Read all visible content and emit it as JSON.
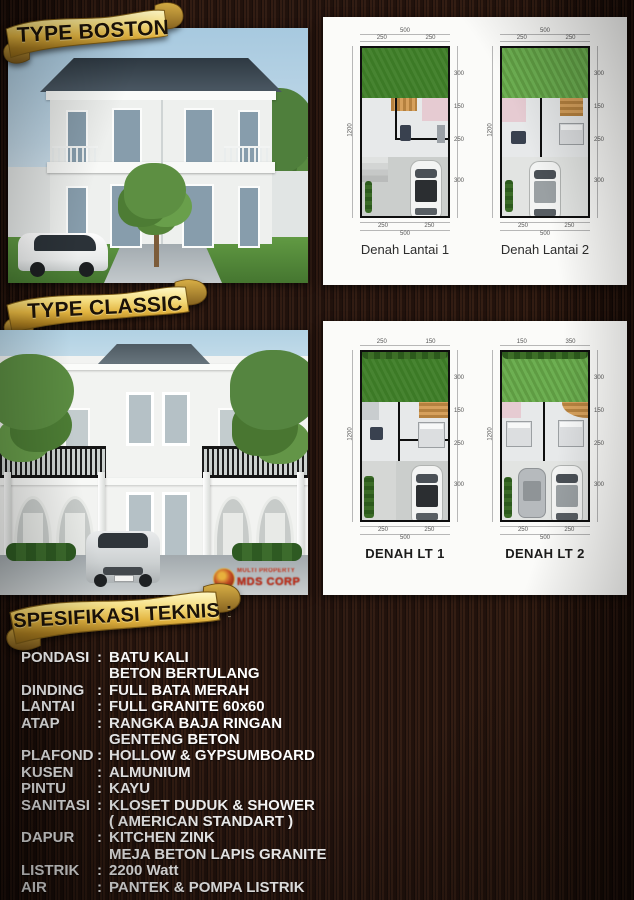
{
  "banners": {
    "boston": "TYPE BOSTON",
    "classic": "TYPE CLASSIC",
    "spec": "SPESIFIKASI TEKNIS :"
  },
  "plans": {
    "boston": [
      {
        "caption": "Denah Lantai 1",
        "dims": {
          "top_total": "500",
          "top": [
            "250",
            "250"
          ],
          "left_total": "1200",
          "right": [
            "300",
            "150",
            "250",
            "300"
          ],
          "bottom": [
            "250",
            "250"
          ],
          "bottom_total": "500"
        }
      },
      {
        "caption": "Denah Lantai 2",
        "dims": {
          "top_total": "500",
          "top": [
            "250",
            "250"
          ],
          "left_total": "1200",
          "right": [
            "300",
            "150",
            "250",
            "300"
          ],
          "bottom": [
            "250",
            "250"
          ],
          "bottom_total": "500"
        }
      }
    ],
    "classic": [
      {
        "caption": "DENAH LT 1",
        "dims": {
          "top_total": "500",
          "top": [
            "250",
            "150"
          ],
          "left_total": "1200",
          "right": [
            "300",
            "150",
            "250",
            "300"
          ],
          "bottom": [
            "250",
            "250"
          ],
          "bottom_total": "500"
        }
      },
      {
        "caption": "DENAH LT 2",
        "dims": {
          "top_total": "500",
          "top": [
            "150",
            "350"
          ],
          "left_total": "1200",
          "right": [
            "300",
            "150",
            "250",
            "300"
          ],
          "bottom": [
            "250",
            "250"
          ],
          "bottom_total": "500"
        }
      }
    ]
  },
  "spec": {
    "rows": [
      {
        "label": "PONDASI",
        "colon": ":",
        "value": "BATU KALI"
      },
      {
        "label": "",
        "colon": "",
        "value": "BETON BERTULANG"
      },
      {
        "label": "DINDING",
        "colon": ":",
        "value": "FULL BATA MERAH"
      },
      {
        "label": "LANTAI",
        "colon": ":",
        "value": "FULL GRANITE 60x60"
      },
      {
        "label": "ATAP",
        "colon": ":",
        "value": "RANGKA BAJA RINGAN"
      },
      {
        "label": "",
        "colon": "",
        "value": "GENTENG BETON"
      },
      {
        "label": "PLAFOND",
        "colon": ":",
        "value": "HOLLOW & GYPSUMBOARD"
      },
      {
        "label": "KUSEN",
        "colon": ":",
        "value": "ALMUNIUM"
      },
      {
        "label": "PINTU",
        "colon": ":",
        "value": "KAYU"
      },
      {
        "label": "SANITASI",
        "colon": ":",
        "value": "KLOSET DUDUK & SHOWER"
      },
      {
        "label": "",
        "colon": "",
        "value": "( AMERICAN STANDART )"
      },
      {
        "label": "DAPUR",
        "colon": ":",
        "value": "KITCHEN ZINK"
      },
      {
        "label": "",
        "colon": "",
        "value": "MEJA BETON LAPIS GRANITE"
      },
      {
        "label": "LISTRIK",
        "colon": ":",
        "value": "2200 Watt"
      },
      {
        "label": "AIR",
        "colon": ":",
        "value": "PANTEK & POMPA LISTRIK"
      }
    ]
  },
  "watermark": {
    "line1": "MULTI PROPERTY",
    "line2": "MDS CORP"
  },
  "colors": {
    "gold": "#e9c558",
    "wood_background": "#261510",
    "spec_text": "#ffffff",
    "banner_text": "#1b1208",
    "garden_green": "#3c7a26",
    "panel_white": "#fbfbf9",
    "watermark_red": "#c0301c",
    "roof_slate": "#3d4a55"
  }
}
